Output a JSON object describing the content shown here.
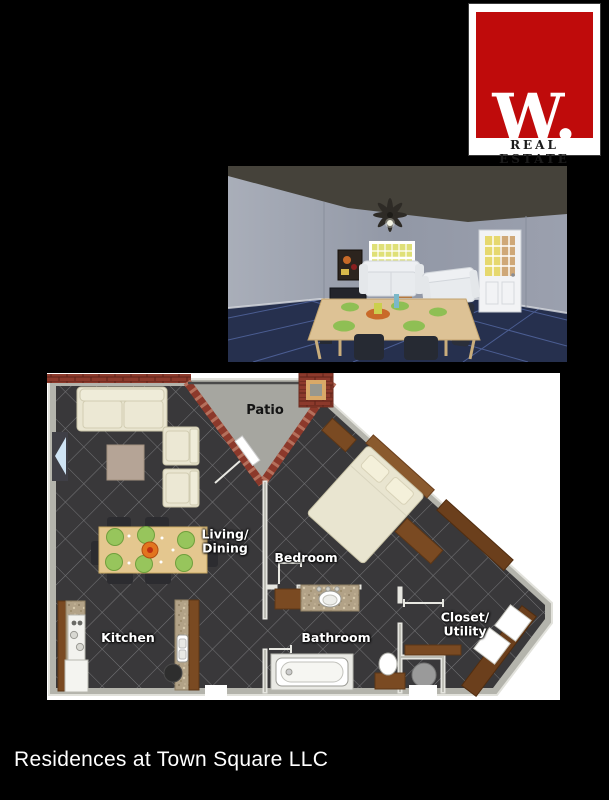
{
  "page": {
    "width": 609,
    "height": 800,
    "background": "#000000"
  },
  "logo": {
    "letter": "W.",
    "subtitle": "REAL ESTATE",
    "colors": {
      "red": "#bf0b0b",
      "box": "#ffffff",
      "text": "#1b1b1b"
    }
  },
  "photo3d": {
    "colors": {
      "wall": "#9aa0ac",
      "ceiling": "#45423a",
      "floor": "#26304e",
      "window_glow": "#dfe077"
    }
  },
  "floor_plan": {
    "labels": {
      "patio": "Patio",
      "living_dining": "Living/\nDining",
      "bedroom": "Bedroom",
      "kitchen": "Kitchen",
      "bathroom": "Bathroom",
      "closet_utility": "Closet/\nUtility"
    },
    "colors": {
      "floor_tile": "#39383a",
      "tile_line": "#8d8d90",
      "wall": "#b4b4ac",
      "brick": "#8c392b",
      "patio_concrete": "#a6a6a0",
      "wood_cabinet": "#7a4a22",
      "granite": "#b2a287",
      "upholstery_cream": "#e9e5d0"
    }
  },
  "footer": {
    "title": "Residences at Town Square LLC"
  }
}
